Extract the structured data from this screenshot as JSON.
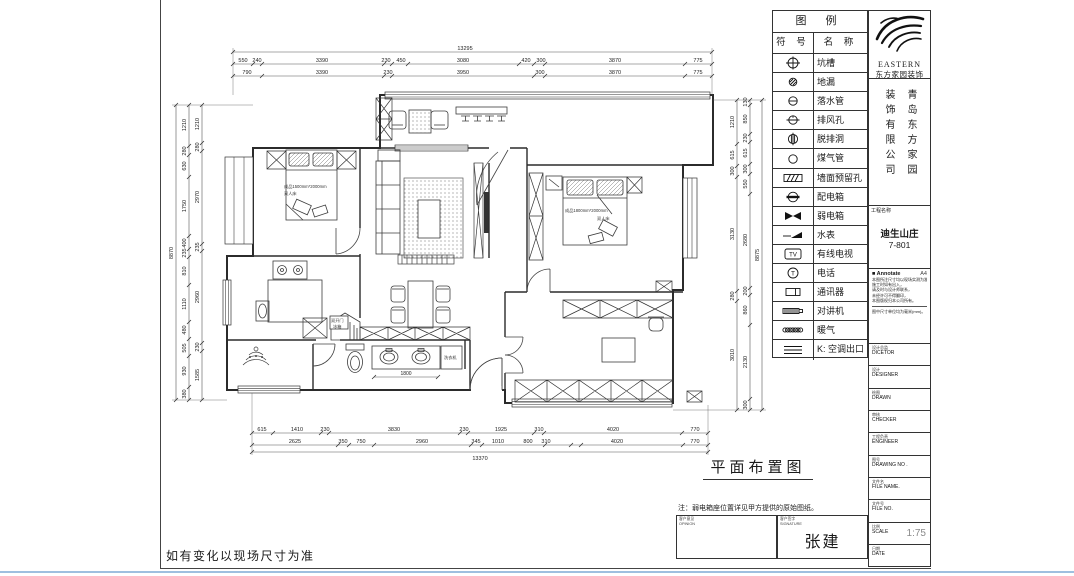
{
  "sheet": {
    "title": "平面布置图",
    "note": "注：弱电箱座位置详见甲方提供的原始图纸。",
    "signer": "张建",
    "sign_left_cn": "客户意见",
    "sign_left_en": "OPINION",
    "sign_right_cn": "客户签字",
    "sign_right_en": "SIGNATURE",
    "footer_warning": "如有变化以现场尺寸为准"
  },
  "legend": {
    "title": "图 例",
    "col_symbol": "符 号",
    "col_name": "名 称",
    "items": [
      {
        "symbol": "pit-circle-cross",
        "name": "坑槽"
      },
      {
        "symbol": "floor-drain",
        "name": "地漏"
      },
      {
        "symbol": "downpipe",
        "name": "落水管"
      },
      {
        "symbol": "vent-hole",
        "name": "排风孔"
      },
      {
        "symbol": "hood-vent-hole",
        "name": "脱排洞"
      },
      {
        "symbol": "gas-pipe",
        "name": "煤气管"
      },
      {
        "symbol": "wall-reserved-hole",
        "name": "墙面预留孔"
      },
      {
        "symbol": "power-distribution-box",
        "name": "配电箱"
      },
      {
        "symbol": "low-voltage-box",
        "name": "弱电箱"
      },
      {
        "symbol": "water-meter",
        "name": "水表"
      },
      {
        "symbol": "cable-tv",
        "name": "有线电视"
      },
      {
        "symbol": "telephone",
        "name": "电话"
      },
      {
        "symbol": "communicator",
        "name": "通讯器"
      },
      {
        "symbol": "intercom",
        "name": "对讲机"
      },
      {
        "symbol": "heating",
        "name": "暖气"
      },
      {
        "symbol": "ac-outlet",
        "name": "K: 空调出口"
      }
    ]
  },
  "company": {
    "logo_word": "EASTERN",
    "logo_sub": "东方家园装饰",
    "name_col_right": "青岛东方家园",
    "name_col_left": "装饰有限公司",
    "project_label": "工程名称",
    "project_name": "迪生山庄",
    "project_no": "7-801"
  },
  "annotate": {
    "header": "Annotate",
    "paper": "A4",
    "lines": [
      "本图所注尺寸均以现场实测为准，",
      "施工时如有出入，",
      "请及时与设计师联系，",
      "未经许可不得翻印，",
      "本图版权归本公司所有。"
    ],
    "footer": "图中尺寸单位均为毫米(mm)。"
  },
  "titleblock": {
    "rows": [
      {
        "cn": "设计总监",
        "en": "DICETOR",
        "value": ""
      },
      {
        "cn": "设计",
        "en": "DESIGNER",
        "value": ""
      },
      {
        "cn": "绘图",
        "en": "DRAWN",
        "value": ""
      },
      {
        "cn": "审核",
        "en": "CHECKER",
        "value": ""
      },
      {
        "cn": "工程负责",
        "en": "ENGINEER",
        "value": ""
      },
      {
        "cn": "图号",
        "en": "DRAWING NO .",
        "value": ""
      },
      {
        "cn": "文件名",
        "en": "FILE NAME.",
        "value": ""
      },
      {
        "cn": "文件号",
        "en": "FILE NO.",
        "value": ""
      },
      {
        "cn": "比例",
        "en": "SCALE",
        "value": "1:75"
      },
      {
        "cn": "日期",
        "en": "DATE",
        "value": ""
      }
    ]
  },
  "plan": {
    "labels": {
      "bed1_spec": "成品1500mm*2000mm",
      "bed1_type": "双人床",
      "bed2_spec": "成品1800mm*2000mm",
      "bed2_type": "双人床",
      "fridge_line1": "双开门",
      "fridge_line2": "冰箱",
      "washer": "洗衣机",
      "vanity_dim": "1800"
    },
    "dims": {
      "top_total": "13295",
      "top_row1": [
        "550",
        "240",
        "3390",
        "230",
        "450",
        "3080",
        "420",
        "300",
        "3870",
        "775"
      ],
      "top_row2": [
        "790",
        "3390",
        "230",
        "3950",
        "300",
        "3870",
        "775"
      ],
      "bottom_row1": [
        "615",
        "1410",
        "230",
        "3830",
        "230",
        "1925",
        "310",
        "4020",
        "770"
      ],
      "bottom_row2": [
        "2625",
        "350",
        "750",
        "2960",
        "345",
        "1010",
        "800",
        "310",
        "4020",
        "770"
      ],
      "bottom_total": "13370",
      "left_outer": [
        "1210",
        "280",
        "630",
        "1750",
        "400",
        "235",
        "810",
        "1110",
        "480",
        "505",
        "930",
        "380"
      ],
      "left_inner": [
        "1210",
        "280",
        "2970",
        "235",
        "2960",
        "230",
        "1585"
      ],
      "left_total": "8870",
      "right_inner": [
        "1210",
        "615",
        "300",
        "3130",
        "280",
        "3010"
      ],
      "right_outer": [
        "130",
        "850",
        "230",
        "615",
        "300",
        "550",
        "2680",
        "200",
        "860",
        "2130",
        "300"
      ],
      "right_total": "8875"
    }
  }
}
